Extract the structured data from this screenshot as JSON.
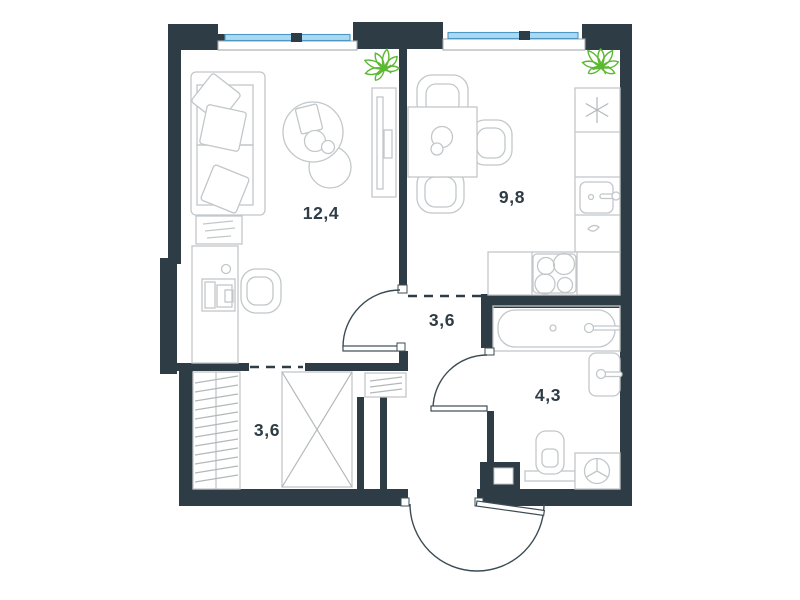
{
  "plan": {
    "rooms": [
      {
        "id": "living-room",
        "area": "12,4"
      },
      {
        "id": "kitchen",
        "area": "9,8"
      },
      {
        "id": "hallway",
        "area": "3,6"
      },
      {
        "id": "wardrobe-hallway",
        "area": "3,6"
      },
      {
        "id": "bathroom",
        "area": "4,3"
      }
    ],
    "colors": {
      "wall": "#2e3d45",
      "furniture_outline": "#c2c7c9",
      "window_glass": "#a9d9f3",
      "window_frame": "#4e97c2",
      "plant": "#5cb832",
      "label_text": "#2e3d45",
      "background": "#ffffff"
    }
  }
}
